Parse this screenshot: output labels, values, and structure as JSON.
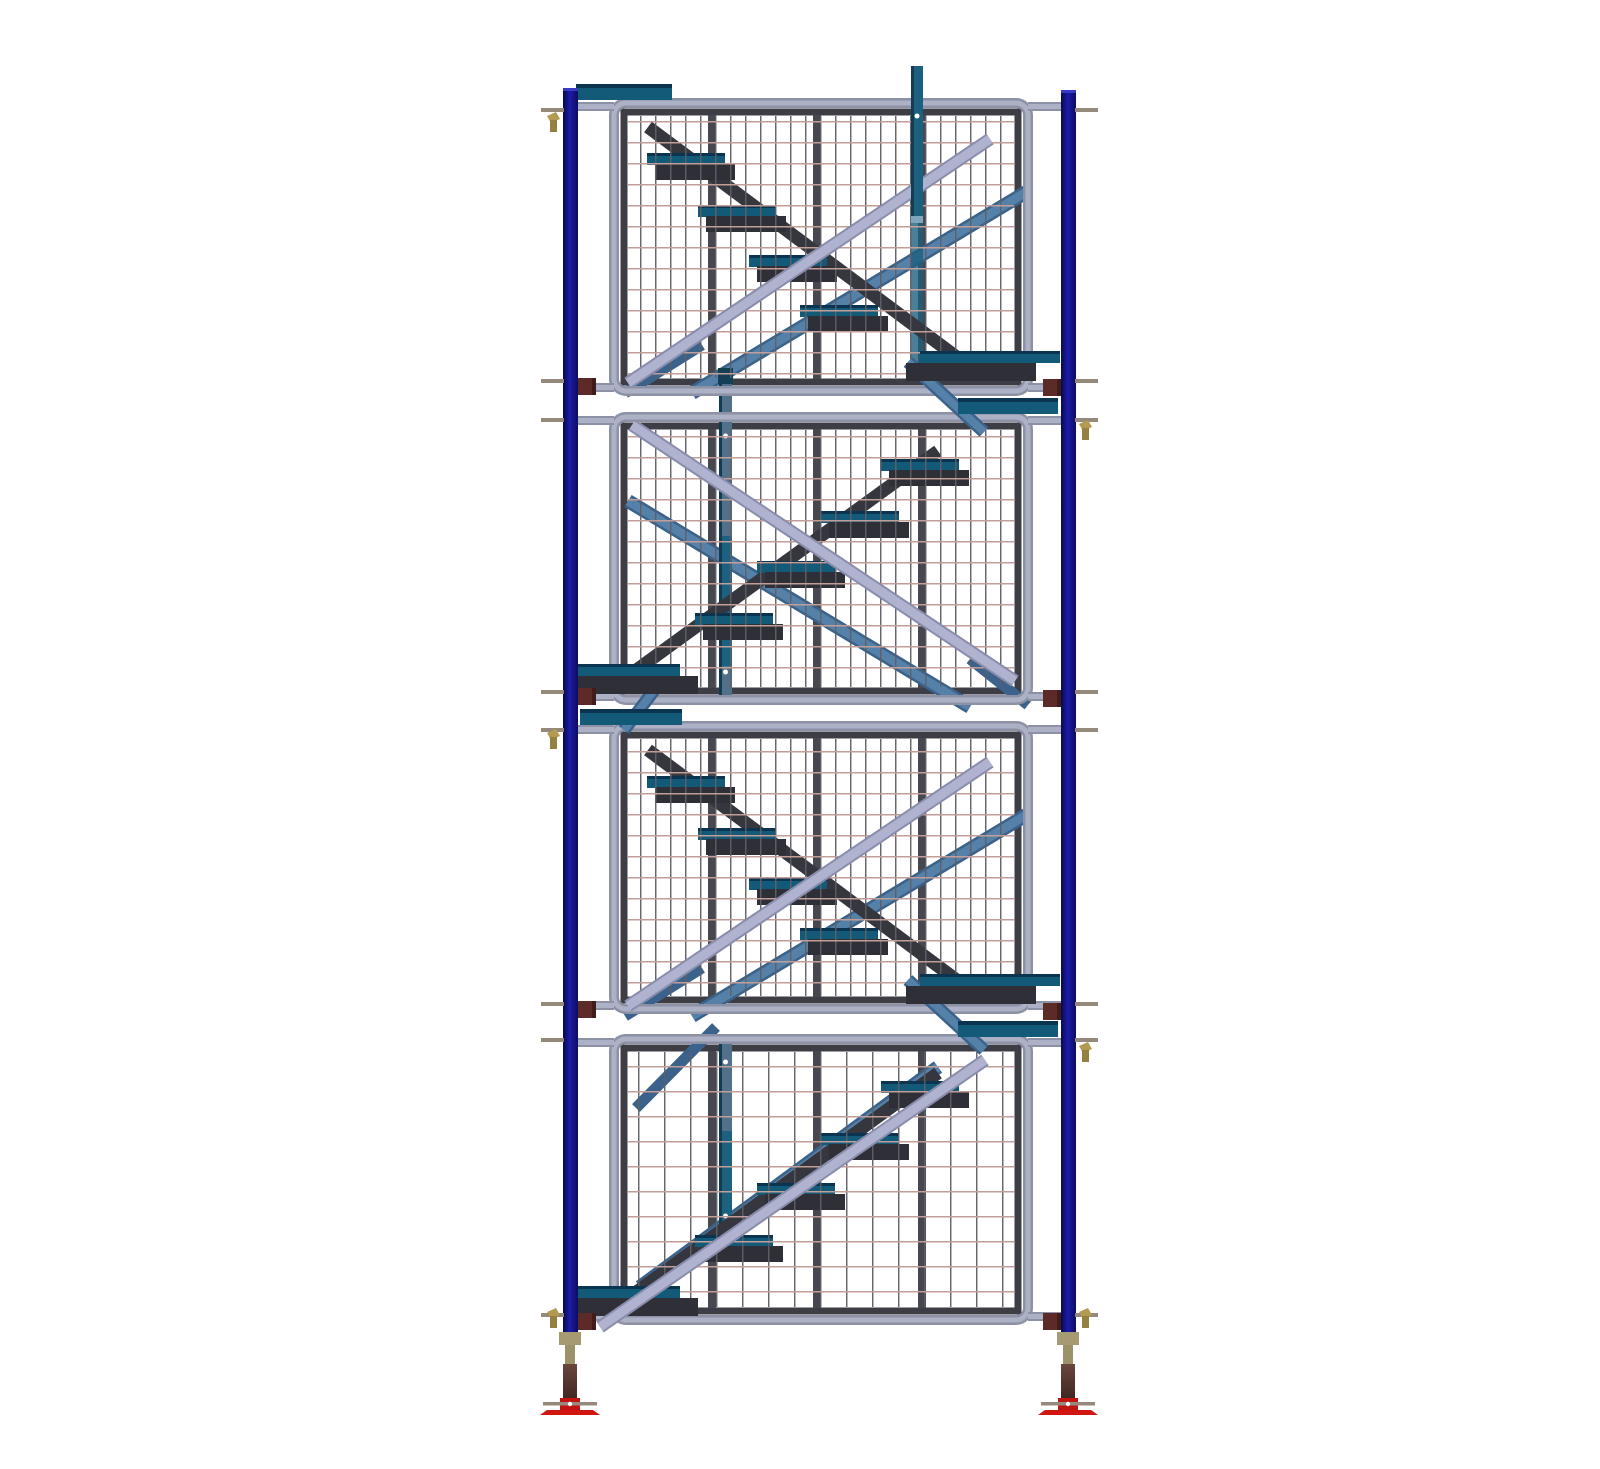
{
  "scene": {
    "description": "3D CAD rendering of a four-lift scaffolding stair tower: four stacked wire-mesh guard panels hung between two dark blue standards, internal alternating stair flights with teal-topped treads, lavender handrail tubes, steel-blue diagonal braces, maroon couplers and pins at each lift joint, and adjustable screw-jack legs with red base plates at the bottom.",
    "canvas": {
      "width": 1600,
      "height": 1437
    },
    "colors": {
      "background": "#ffffff",
      "post_navy_dark": "#08084e",
      "post_navy": "#1c1ca8",
      "post_navy_edge": "#0c0c62",
      "post_cap": "#3a3ac2",
      "tube_gray_dark": "#8d91a6",
      "tube_gray_light": "#adb1c5",
      "frame_dark": "#3d3d45",
      "stiffener": "#47474f",
      "mesh_horizontal": "#c29e98",
      "mesh_vertical": "#5e5e66",
      "stringer": "#36363e",
      "tread_teal": "#135a78",
      "tread_navy_line": "#0a3450",
      "tread_body": "#2f2f37",
      "brace_blue_dark": "#3a628a",
      "brace_blue": "#5581a8",
      "rail_lavender_dark": "#898dac",
      "rail_lavender": "#b0b3cf",
      "teal_post": "#1d5f7e",
      "teal_post_edge": "#113c52",
      "teal_post_cap": "#7fa6ba",
      "newel_body": "#53708a",
      "newel_teal": "#1d6080",
      "newel_cap": "#133f54",
      "coupler_maroon": "#5c2b28",
      "coupler_maroon_dark": "#401c1a",
      "pin_gray": "#94897b",
      "wingnut_gold": "#b29a50",
      "wingnut_gold_dark": "#94803f",
      "jack_collar": "#a59a72",
      "jack_sleeve": "#9c9168",
      "jack_screw_top": "#6b463c",
      "jack_screw_bottom": "#3c241f",
      "jack_block_red": "#c11310",
      "base_red": "#d11510",
      "hole_white": "#ffffff"
    },
    "posts": {
      "left_x": 523,
      "right_x": 1021,
      "width": 15,
      "left_top": 72,
      "right_top": 74,
      "bottom": 1317
    },
    "panel_frame": {
      "x": 570,
      "w": 422
    },
    "panels": [
      {
        "y": 83,
        "h": 296,
        "dir": "odd",
        "rail": "cross",
        "mesh": 0
      },
      {
        "y": 397,
        "h": 291,
        "dir": "even",
        "rail": "cross",
        "mesh": 0
      },
      {
        "y": 706,
        "h": 291,
        "dir": "odd",
        "rail": "cross",
        "mesh": 0
      },
      {
        "y": 1019,
        "h": 289,
        "dir": "even",
        "rail": "parallel",
        "mesh": 1
      }
    ],
    "mesh_cells": [
      [
        15,
        21
      ],
      [
        26,
        25
      ]
    ],
    "stiffeners": [
      672,
      777,
      882
    ],
    "stair": {
      "stringer_w": 13,
      "odd": {
        "stringer": [
          608,
          28,
          930,
          268
        ],
        "treads": [
          [
            646,
            66
          ],
          [
            697,
            118
          ],
          [
            748,
            168
          ],
          [
            799,
            218
          ]
        ],
        "landing": {
          "teal": [
            880,
            252,
            140
          ],
          "body": [
            866,
            264,
            130
          ]
        }
      },
      "even": {
        "stringer": [
          898,
          38,
          562,
          282
        ],
        "treads": [
          [
            880,
            58
          ],
          [
            820,
            110
          ],
          [
            756,
            160
          ],
          [
            694,
            212
          ]
        ],
        "landing": {
          "teal": [
            532,
            251,
            108
          ],
          "body": [
            536,
            263,
            122
          ]
        }
      }
    },
    "rails": {
      "odd": {
        "lavender": [
          588,
          284,
          950,
          40
        ],
        "blue": [
          652,
          294,
          988,
          92
        ],
        "blue2": [
          585,
          294,
          662,
          246
        ]
      },
      "even": {
        "lavender": [
          592,
          12,
          975,
          268
        ],
        "blue": [
          588,
          88,
          930,
          294
        ],
        "blue2": [
          930,
          246,
          988,
          292
        ]
      },
      "parallel": {
        "lavender": [
          560,
          292,
          945,
          25
        ],
        "blue": [
          600,
          252,
          898,
          32
        ],
        "blue2": [
          596,
          73,
          676,
          -8
        ]
      }
    },
    "gap_bars": [
      [
        536,
        68,
        96
      ],
      [
        918,
        382,
        100
      ],
      [
        540,
        693,
        102
      ],
      [
        918,
        1005,
        100
      ]
    ],
    "gap_stubs": [
      [
        868,
        346,
        944,
        416
      ],
      [
        622,
        664,
        584,
        714
      ],
      [
        868,
        964,
        944,
        1034
      ]
    ],
    "pin_levels": [
      92,
      363,
      402,
      674,
      712,
      986,
      1022,
      1297
    ],
    "wingnuts": [
      [
        "left",
        96
      ],
      [
        "right",
        404
      ],
      [
        "left",
        713
      ],
      [
        "right",
        1026
      ],
      [
        "left",
        1292
      ],
      [
        "right",
        1292
      ]
    ],
    "couplers": [
      [
        "left",
        362
      ],
      [
        "right",
        363
      ],
      [
        "left",
        672
      ],
      [
        "right",
        674
      ],
      [
        "left",
        985
      ],
      [
        "right",
        987
      ],
      [
        "left",
        1297
      ],
      [
        "right",
        1297
      ]
    ],
    "post_a": {
      "x": 871,
      "w": 12,
      "front": [
        50,
        150
      ],
      "cap_y": 200,
      "dim": [
        207,
        141
      ],
      "dot_y": 100
    },
    "post_b": [
      {
        "x": 679,
        "w": 13,
        "cap": [
          352,
          16
        ],
        "body": [
          368,
          688
        ],
        "teal": [
          520,
          650
        ],
        "dots": [
          420,
          656
        ]
      },
      {
        "x": 679,
        "w": 13,
        "cap": null,
        "body": [
          1022,
          1240
        ],
        "teal": [
          1115,
          1240
        ],
        "dots": [
          1046,
          1200
        ]
      }
    ],
    "jacks": {
      "centers": [
        530,
        1028
      ],
      "collar": [
        1316,
        13
      ],
      "sleeve": [
        1329,
        19
      ],
      "screw": [
        1348,
        38
      ],
      "block": [
        1382,
        13
      ],
      "pin_y": 1386,
      "plate": [
        1394,
        46,
        5
      ]
    }
  }
}
